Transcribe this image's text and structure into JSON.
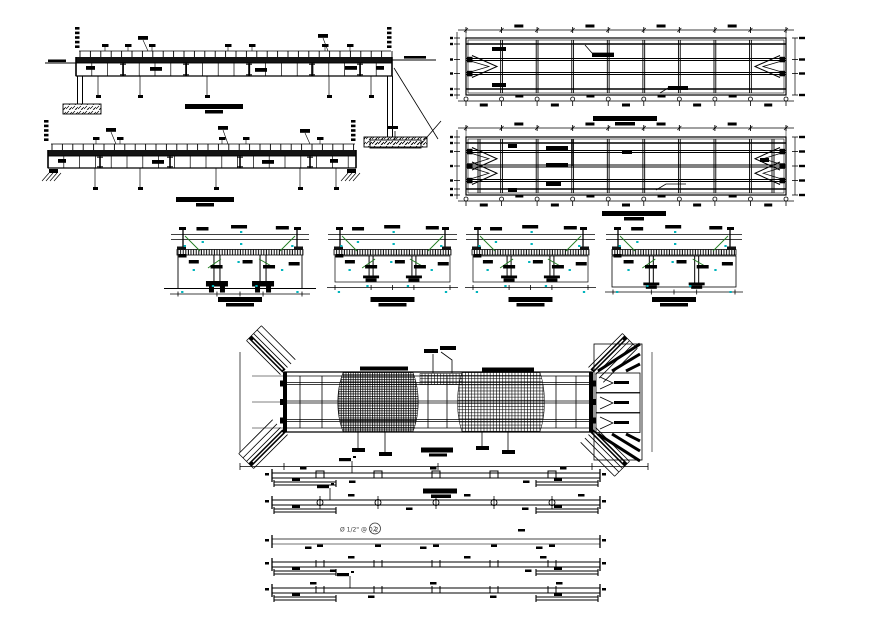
{
  "drawing": {
    "type": "bridge-construction-cad-sheet",
    "background": "#ffffff"
  },
  "colors": {
    "ink": "#000000",
    "dim_gray": "#444444",
    "annotation_cyan": "#00b4bc",
    "leader_green": "#1e7a1e",
    "note_text": "#3a3a3a"
  },
  "annotations": {
    "rebar_note": "Ø 1/2\" @ 0.2",
    "rebar_callout": "2"
  },
  "views": {
    "elevation_1": {
      "label": "bridge longitudinal elevation (upper)"
    },
    "elevation_2": {
      "label": "bridge longitudinal elevation (lower)"
    },
    "plan_1": {
      "label": "deck framing plan (upper)"
    },
    "plan_2": {
      "label": "deck framing plan (lower)"
    },
    "section_1": {
      "label": "cross section 1"
    },
    "section_2": {
      "label": "cross section 2"
    },
    "section_3": {
      "label": "cross section 3"
    },
    "section_4": {
      "label": "cross section 4"
    },
    "foundation_plan": {
      "label": "abutment / reinforcement plan with wing walls"
    },
    "bar_details": {
      "label": "reinforcement bar bending details"
    }
  }
}
